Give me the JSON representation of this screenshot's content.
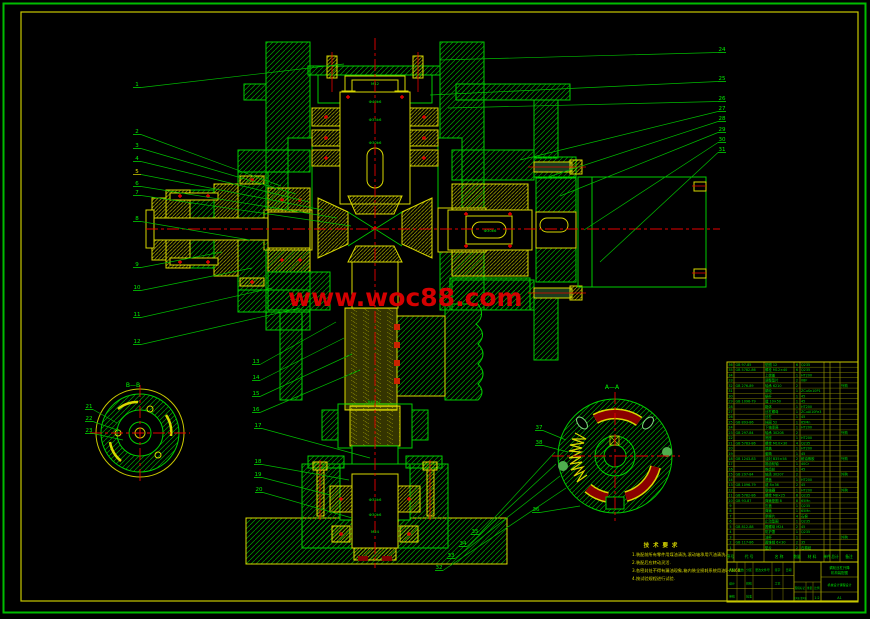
{
  "colors": {
    "green": "#00cc00",
    "bright_green": "#00ff00",
    "yellow": "#e0e000",
    "red": "#e60000",
    "dark_red": "#8b0000",
    "watermark": "#d40000",
    "border_outer": "#00bb00",
    "border_inner": "#d8d800"
  },
  "watermark": {
    "text": "www.woc88.com"
  },
  "sections": [
    {
      "label": "B—B",
      "x": 133,
      "y": 387
    },
    {
      "label": "A—A",
      "x": 612,
      "y": 389
    }
  ],
  "dims": [
    {
      "t": "M12",
      "x": 375,
      "y": 85
    },
    {
      "t": "Ф40k6",
      "x": 375,
      "y": 103
    },
    {
      "t": "Ф35k6",
      "x": 375,
      "y": 121
    },
    {
      "t": "Ф30k6",
      "x": 375,
      "y": 144
    },
    {
      "t": "Ф30k6",
      "x": 490,
      "y": 232
    },
    {
      "t": "Tr40×7",
      "x": 374,
      "y": 403
    },
    {
      "t": "Ф35k6",
      "x": 375,
      "y": 501
    },
    {
      "t": "Ф30k6",
      "x": 375,
      "y": 516
    },
    {
      "t": "M24",
      "x": 375,
      "y": 533
    }
  ],
  "balloons": [
    {
      "n": "1",
      "x": 134,
      "y": 86,
      "tx": 344,
      "ty": 64
    },
    {
      "n": "2",
      "x": 134,
      "y": 133,
      "tx": 281,
      "ty": 186
    },
    {
      "n": "3",
      "x": 134,
      "y": 147,
      "tx": 296,
      "ty": 194
    },
    {
      "n": "4",
      "x": 134,
      "y": 160,
      "tx": 309,
      "ty": 202
    },
    {
      "n": "5",
      "x": 134,
      "y": 173,
      "tx": 323,
      "ty": 210,
      "c": "#e0e000"
    },
    {
      "n": "6",
      "x": 134,
      "y": 185,
      "tx": 337,
      "ty": 218
    },
    {
      "n": "7",
      "x": 134,
      "y": 194,
      "tx": 351,
      "ty": 226
    },
    {
      "n": "8",
      "x": 134,
      "y": 220,
      "tx": 250,
      "ty": 240
    },
    {
      "n": "9",
      "x": 134,
      "y": 266,
      "tx": 222,
      "ty": 252
    },
    {
      "n": "10",
      "x": 134,
      "y": 289,
      "tx": 252,
      "ty": 268
    },
    {
      "n": "11",
      "x": 134,
      "y": 316,
      "tx": 272,
      "ty": 288
    },
    {
      "n": "12",
      "x": 134,
      "y": 343,
      "tx": 300,
      "ty": 308
    },
    {
      "n": "13",
      "x": 253,
      "y": 363,
      "tx": 336,
      "ty": 322
    },
    {
      "n": "14",
      "x": 253,
      "y": 379,
      "tx": 344,
      "ty": 338
    },
    {
      "n": "15",
      "x": 253,
      "y": 395,
      "tx": 352,
      "ty": 354
    },
    {
      "n": "16",
      "x": 253,
      "y": 411,
      "tx": 360,
      "ty": 370
    },
    {
      "n": "17",
      "x": 255,
      "y": 427,
      "tx": 370,
      "ty": 458
    },
    {
      "n": "18",
      "x": 255,
      "y": 463,
      "tx": 349,
      "ty": 480
    },
    {
      "n": "19",
      "x": 255,
      "y": 476,
      "tx": 330,
      "ty": 495
    },
    {
      "n": "20",
      "x": 256,
      "y": 491,
      "tx": 352,
      "ty": 518
    },
    {
      "n": "21",
      "x": 86,
      "y": 408,
      "tx": 117,
      "ty": 423
    },
    {
      "n": "22",
      "x": 86,
      "y": 420,
      "tx": 120,
      "ty": 431
    },
    {
      "n": "23",
      "x": 86,
      "y": 432,
      "tx": 123,
      "ty": 440
    },
    {
      "n": "24",
      "x": 719,
      "y": 51,
      "tx": 440,
      "ty": 60
    },
    {
      "n": "25",
      "x": 719,
      "y": 80,
      "tx": 430,
      "ty": 95
    },
    {
      "n": "26",
      "x": 719,
      "y": 100,
      "tx": 448,
      "ty": 108
    },
    {
      "n": "27",
      "x": 719,
      "y": 110,
      "tx": 520,
      "ty": 160
    },
    {
      "n": "28",
      "x": 719,
      "y": 120,
      "tx": 545,
      "ty": 178
    },
    {
      "n": "29",
      "x": 719,
      "y": 131,
      "tx": 560,
      "ty": 196
    },
    {
      "n": "30",
      "x": 719,
      "y": 141,
      "tx": 584,
      "ty": 230
    },
    {
      "n": "31",
      "x": 719,
      "y": 151,
      "tx": 600,
      "ty": 262
    },
    {
      "n": "32",
      "x": 436,
      "y": 569,
      "tx": 566,
      "ty": 488
    },
    {
      "n": "33",
      "x": 448,
      "y": 557,
      "tx": 560,
      "ty": 476
    },
    {
      "n": "34",
      "x": 460,
      "y": 545,
      "tx": 556,
      "ty": 464
    },
    {
      "n": "35",
      "x": 472,
      "y": 533,
      "tx": 555,
      "ty": 452
    },
    {
      "n": "36",
      "x": 533,
      "y": 511,
      "tx": 580,
      "ty": 506
    },
    {
      "n": "37",
      "x": 536,
      "y": 429,
      "tx": 566,
      "ty": 440
    },
    {
      "n": "38",
      "x": 536,
      "y": 444,
      "tx": 568,
      "ty": 452
    }
  ],
  "notes": {
    "title": "技 术 要 求",
    "items": [
      "1.装配前所有零件用煤油清洗,滚动轴承用汽油清洗.",
      "2.装配后应转动灵活.",
      "3.各密封处不得有漏油现象,箱内装全损耗系统用油L-AN68.",
      "4.按试验规程进行试验."
    ]
  },
  "bom": {
    "headers": [
      "序号",
      "代  号",
      "名  称",
      "数量",
      "材  料",
      "单件",
      "总计",
      "备注"
    ],
    "rows": [
      {
        "no": "36",
        "code": "GB 97-85",
        "name": "垫圈 12",
        "qty": "6",
        "mat": "Q235",
        "rem": ""
      },
      {
        "no": "35",
        "code": "GB 5782-86",
        "name": "螺栓 M12×40",
        "qty": "6",
        "mat": "Q235",
        "rem": ""
      },
      {
        "no": "34",
        "code": "",
        "name": "上端盖",
        "qty": "1",
        "mat": "HT200",
        "rem": ""
      },
      {
        "no": "33",
        "code": "",
        "name": "调整垫片",
        "qty": "2",
        "mat": "08F",
        "rem": ""
      },
      {
        "no": "32",
        "code": "GB 276-89",
        "name": "轴承 6210",
        "qty": "2",
        "mat": "",
        "rem": "外购"
      },
      {
        "no": "31",
        "code": "",
        "name": "蜗轮",
        "qty": "1",
        "mat": "ZCuSn10P1",
        "rem": ""
      },
      {
        "no": "30",
        "code": "",
        "name": "蜗杆",
        "qty": "1",
        "mat": "45",
        "rem": ""
      },
      {
        "no": "29",
        "code": "GB 1096-79",
        "name": "键 10×50",
        "qty": "1",
        "mat": "45",
        "rem": ""
      },
      {
        "no": "28",
        "code": "",
        "name": "箱体",
        "qty": "1",
        "mat": "HT200",
        "rem": ""
      },
      {
        "no": "27",
        "code": "",
        "name": "丝杠螺母",
        "qty": "1",
        "mat": "ZCuAl10Fe3",
        "rem": ""
      },
      {
        "no": "26",
        "code": "",
        "name": "丝杠",
        "qty": "1",
        "mat": "45",
        "rem": ""
      },
      {
        "no": "25",
        "code": "GB 893-86",
        "name": "挡圈 52",
        "qty": "1",
        "mat": "65Mn",
        "rem": ""
      },
      {
        "no": "24",
        "code": "",
        "name": "下轴承座",
        "qty": "1",
        "mat": "HT200",
        "rem": ""
      },
      {
        "no": "23",
        "code": "GB 297-84",
        "name": "轴承 30208",
        "qty": "2",
        "mat": "",
        "rem": "外购"
      },
      {
        "no": "22",
        "code": "",
        "name": "底座",
        "qty": "1",
        "mat": "HT200",
        "rem": ""
      },
      {
        "no": "21",
        "code": "GB 5783-86",
        "name": "螺栓 M10×30",
        "qty": "4",
        "mat": "Q235",
        "rem": ""
      },
      {
        "no": "20",
        "code": "",
        "name": "端盖",
        "qty": "1",
        "mat": "HT200",
        "rem": ""
      },
      {
        "no": "19",
        "code": "",
        "name": "套筒",
        "qty": "1",
        "mat": "45",
        "rem": ""
      },
      {
        "no": "18",
        "code": "GB 1243-83",
        "name": "油封 B35×58",
        "qty": "2",
        "mat": "耐油橡胶",
        "rem": "外购"
      },
      {
        "no": "17",
        "code": "",
        "name": "锥齿轮轴",
        "qty": "1",
        "mat": "40Cr",
        "rem": ""
      },
      {
        "no": "16",
        "code": "",
        "name": "锥齿轮",
        "qty": "1",
        "mat": "45",
        "rem": ""
      },
      {
        "no": "15",
        "code": "GB 297-84",
        "name": "轴承 30207",
        "qty": "2",
        "mat": "",
        "rem": "外购"
      },
      {
        "no": "14",
        "code": "",
        "name": "透盖",
        "qty": "1",
        "mat": "HT200",
        "rem": ""
      },
      {
        "no": "13",
        "code": "GB 1096-79",
        "name": "键 8×36",
        "qty": "2",
        "mat": "45",
        "rem": ""
      },
      {
        "no": "12",
        "code": "",
        "name": "联轴器",
        "qty": "1",
        "mat": "HT200",
        "rem": "外购"
      },
      {
        "no": "11",
        "code": "GB 5782-86",
        "name": "螺栓 M8×25",
        "qty": "8",
        "mat": "Q235",
        "rem": ""
      },
      {
        "no": "10",
        "code": "GB 93-87",
        "name": "弹簧垫圈 8",
        "qty": "8",
        "mat": "65Mn",
        "rem": ""
      },
      {
        "no": "9",
        "code": "",
        "name": "压盖",
        "qty": "1",
        "mat": "Q235",
        "rem": ""
      },
      {
        "no": "8",
        "code": "",
        "name": "弹簧",
        "qty": "1",
        "mat": "65Mn",
        "rem": ""
      },
      {
        "no": "7",
        "code": "",
        "name": "摩擦片",
        "qty": "4",
        "mat": "石棉",
        "rem": ""
      },
      {
        "no": "6",
        "code": "",
        "name": "止动垫圈",
        "qty": "1",
        "mat": "Q235",
        "rem": ""
      },
      {
        "no": "5",
        "code": "GB 812-88",
        "name": "圆螺母 M24",
        "qty": "2",
        "mat": "45",
        "rem": ""
      },
      {
        "no": "4",
        "code": "",
        "name": "防护罩",
        "qty": "1",
        "mat": "Q235",
        "rem": ""
      },
      {
        "no": "3",
        "code": "",
        "name": "油杯",
        "qty": "1",
        "mat": "",
        "rem": "外购"
      },
      {
        "no": "2",
        "code": "GB 117-86",
        "name": "圆锥销 6×30",
        "qty": "2",
        "mat": "35",
        "rem": ""
      },
      {
        "no": "1",
        "code": "",
        "name": "垫片",
        "qty": "2",
        "mat": "石棉纸",
        "rem": ""
      }
    ]
  },
  "title_block": {
    "left_rows": [
      [
        "标记",
        "处数",
        "分区",
        "更改文件号",
        "签字",
        "日期"
      ],
      [
        "设计",
        "",
        "校核",
        "",
        "工艺",
        ""
      ],
      [
        "审核",
        "",
        "批准",
        "",
        "",
        ""
      ]
    ],
    "mid_labels": [
      "阶段标记",
      "重量",
      "比例"
    ],
    "scale": "1:2",
    "sheet": "共1张 第1张",
    "title": "蜗轮丝杠升降机构装配图",
    "org": "机械设计课程设计",
    "paper": "A1"
  }
}
